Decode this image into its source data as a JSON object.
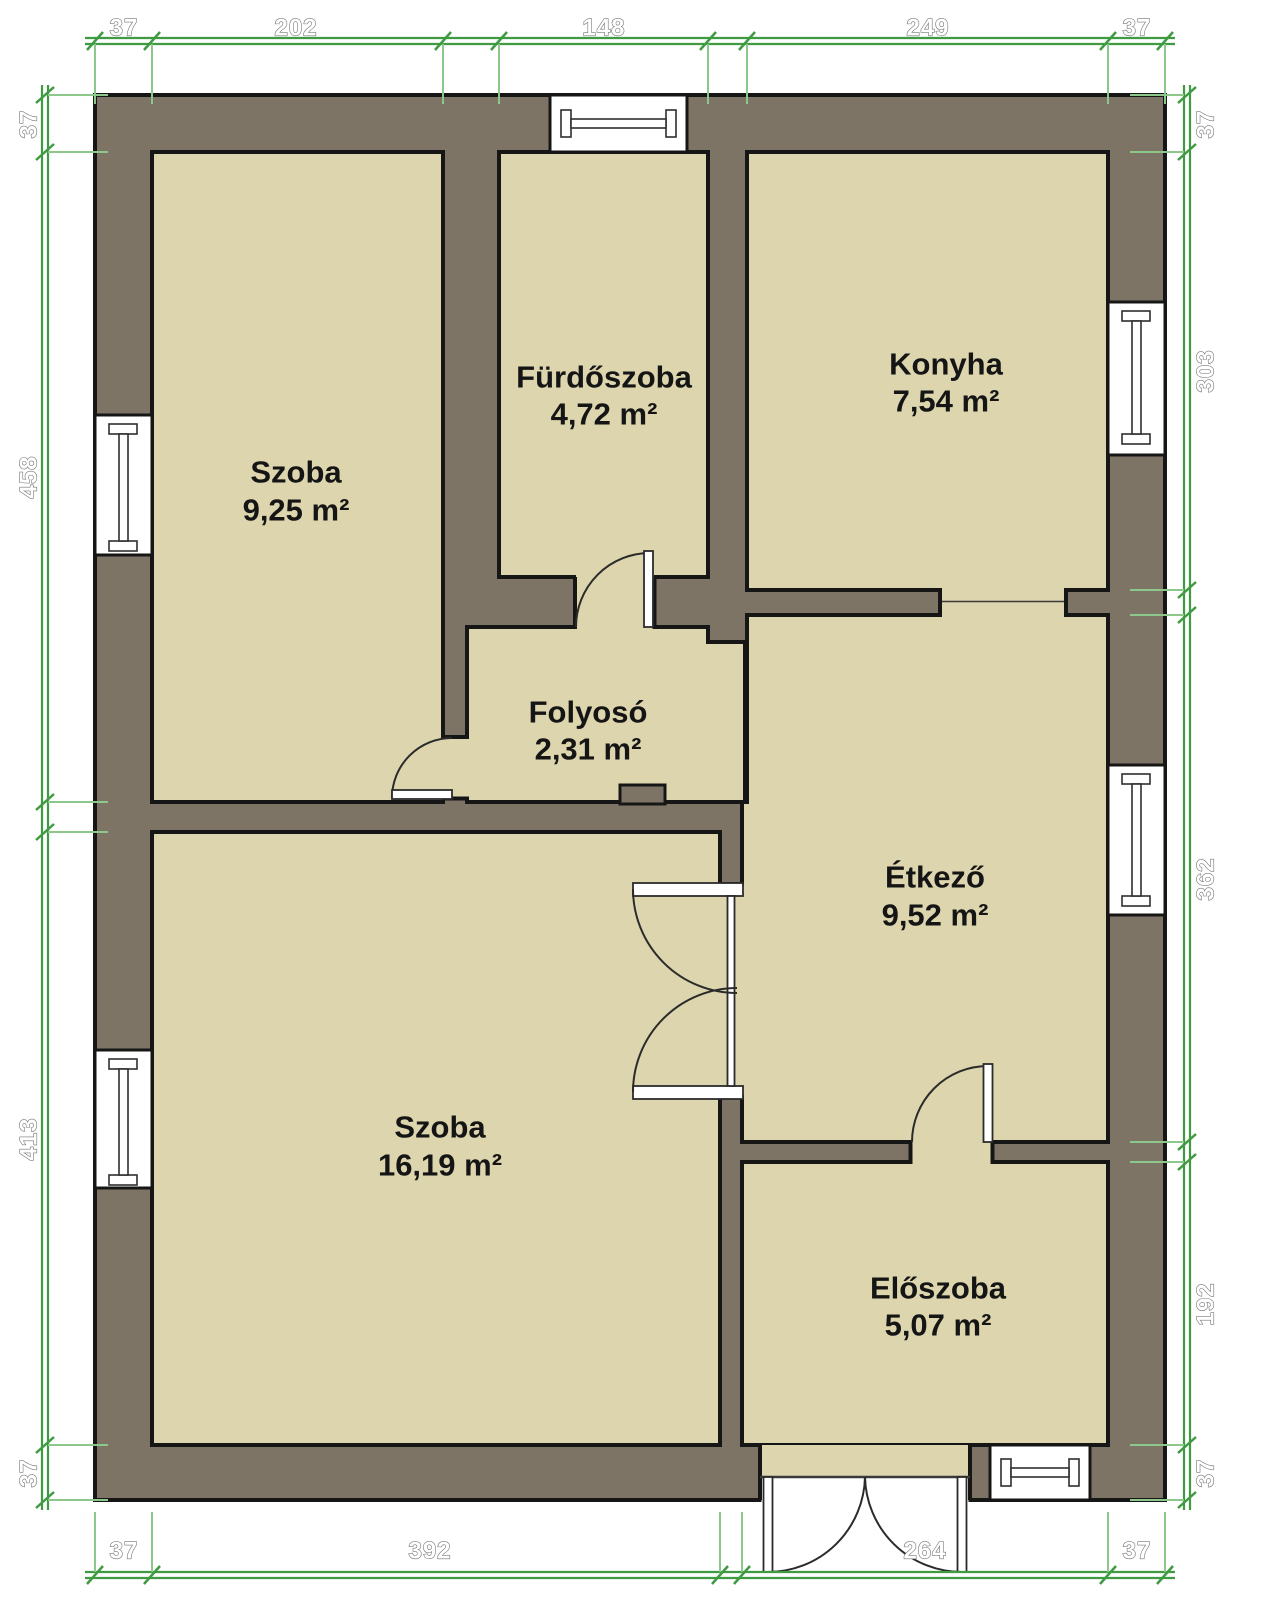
{
  "rooms": [
    {
      "name": "Szoba",
      "area": "9,25 m²"
    },
    {
      "name": "Fürdőszoba",
      "area": "4,72 m²"
    },
    {
      "name": "Konyha",
      "area": "7,54 m²"
    },
    {
      "name": "Folyosó",
      "area": "2,31 m²"
    },
    {
      "name": "Étkező",
      "area": "9,52 m²"
    },
    {
      "name": "Szoba",
      "area": "16,19 m²"
    },
    {
      "name": "Előszoba",
      "area": "5,07 m²"
    }
  ],
  "dims": {
    "top": [
      "37",
      "202",
      "148",
      "249",
      "37"
    ],
    "bottom": [
      "37",
      "392",
      "264",
      "37"
    ],
    "left": [
      "37",
      "458",
      "413",
      "37"
    ],
    "right": [
      "37",
      "303",
      "362",
      "192",
      "37"
    ]
  },
  "colors": {
    "wall": "#7d7466",
    "floor": "#dcd5ad",
    "outline": "#161616",
    "dimension_green": "#3f9b41",
    "dimension_extension_green": "#8cc88c",
    "background": "#ffffff"
  }
}
